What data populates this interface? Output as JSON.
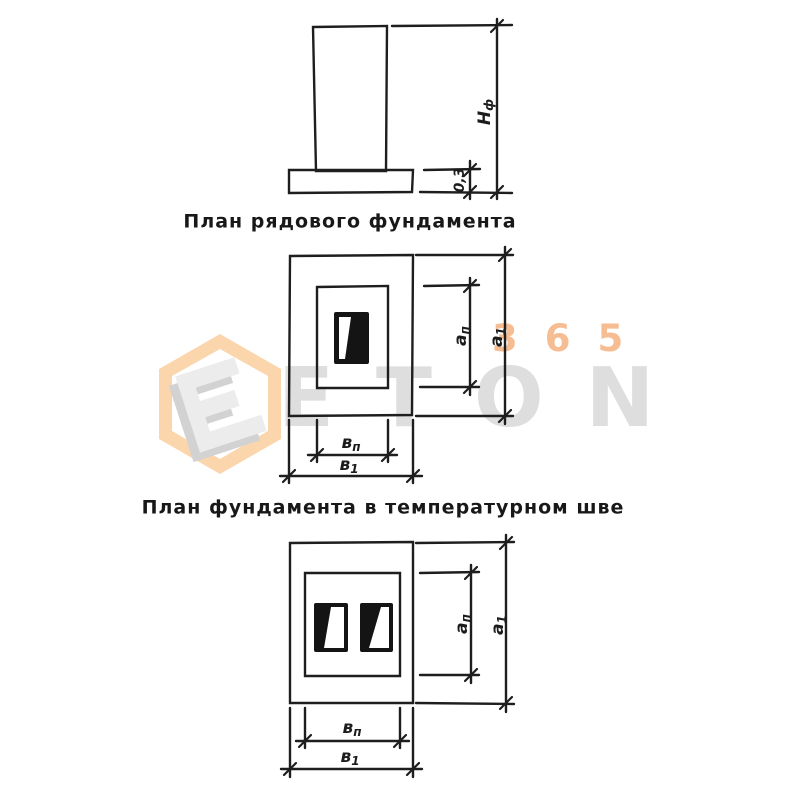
{
  "watermark": {
    "brand": "ETON",
    "number": "365",
    "logo_orange": "#fbd5ab",
    "text_gray": "#dedede",
    "number_orange": "#f6bd92"
  },
  "titles": {
    "plan_ordinary": "План рядового фундамента",
    "plan_joint": "План фундамента в температурном шве"
  },
  "labels": {
    "nf": {
      "main": "Н",
      "sub": "ф"
    },
    "footing": "0,3",
    "a_p": {
      "main": "а",
      "sub": "п"
    },
    "a_1": {
      "main": "а",
      "sub": "1"
    },
    "b_p": {
      "main": "в",
      "sub": "п"
    },
    "b_1": {
      "main": "в",
      "sub": "1"
    }
  },
  "colors": {
    "line": "#1e1e1e",
    "fill_dark": "#141414",
    "background": "#ffffff"
  }
}
